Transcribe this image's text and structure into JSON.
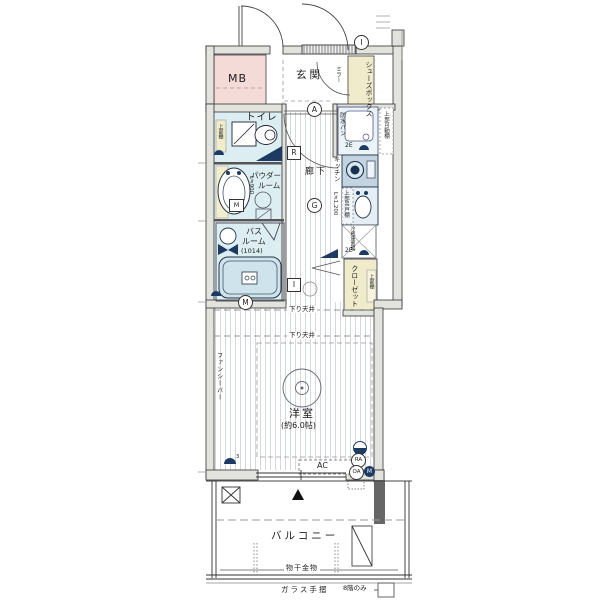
{
  "floorplan": {
    "markers": {
      "i_top": "I",
      "a": "A",
      "g": "G",
      "r": "R",
      "i_hall": "I",
      "m_bath": "M",
      "m_box": "M",
      "ra": "RA",
      "oa": "OA",
      "m_dot": "M",
      "sup3": "3"
    },
    "rooms": {
      "mb": "MB",
      "genkan": "玄関",
      "shoe_box": "シューズボックス",
      "mirror": "ミラー",
      "toilet": "トイレ",
      "toilet_shelf": "上部棚",
      "powder_lines": [
        "パウダー",
        "ルーム"
      ],
      "powder_length": "L≒900",
      "bath_lines": [
        "バス",
        "ルーム"
      ],
      "bath_size": "(1014)",
      "hallway": "廊下",
      "laundry_pan": "防水パン",
      "laundry_shelf": "上部可動棚",
      "laundry_outlet": "2E",
      "kitchen": "キッチン",
      "kitchen_length": "L≒1,200",
      "kitchen_cupboard": "上部吊戸棚",
      "fridge": "冷蔵庫置場",
      "fridge_outlet": "2E",
      "closet": "クローゼット",
      "closet_shelf": "上部棚",
      "room": "洋室",
      "room_size": "(約6.0帖)",
      "fancy_bar": "ファンシーバー",
      "lowered_ceiling_1": "下り天井",
      "lowered_ceiling_2": "下り天井",
      "ac": "AC",
      "balcony": "バルコニー",
      "laundry_hardware": "物干金物",
      "glass_railing": "ガラス手摺",
      "floor_note": "8階のみ"
    },
    "colors": {
      "wet_room": "#dceef2",
      "cabinet": "#f0eccb",
      "mb_pink": "#f4dbd7",
      "navy": "#1d3a63",
      "tub": "#cfe3ed"
    }
  }
}
